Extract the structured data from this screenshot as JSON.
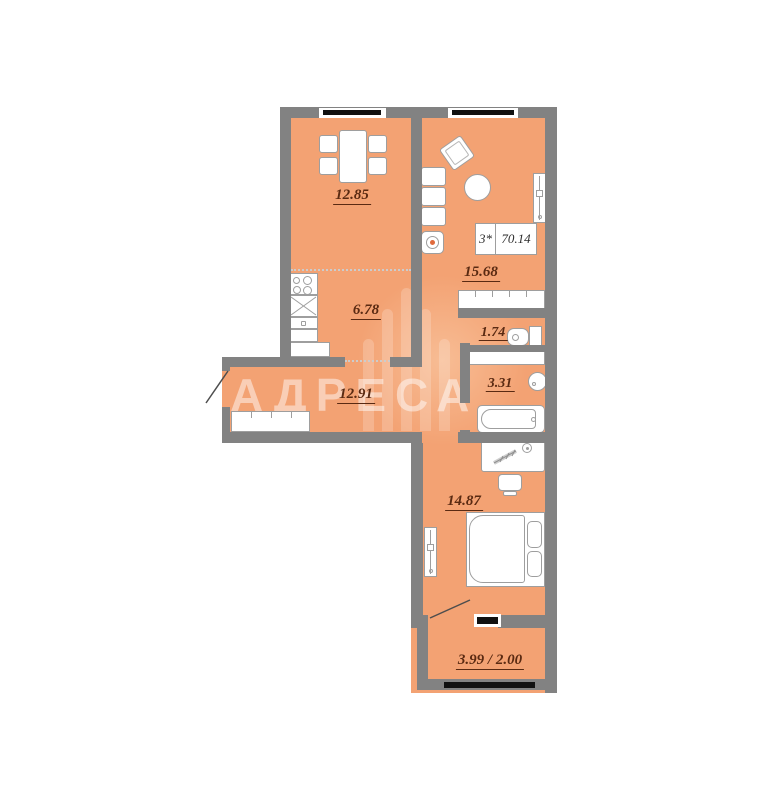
{
  "floorplan": {
    "watermark": "АДРЕСА",
    "unit_info": {
      "type": "3*",
      "total_area": "70.14"
    },
    "rooms": {
      "dining": "12.85",
      "kitchen": "6.78",
      "living": "15.68",
      "wc": "1.74",
      "bathroom": "3.31",
      "hallway": "12.91",
      "bedroom": "14.87",
      "balcony": "3.99 / 2.00"
    }
  }
}
